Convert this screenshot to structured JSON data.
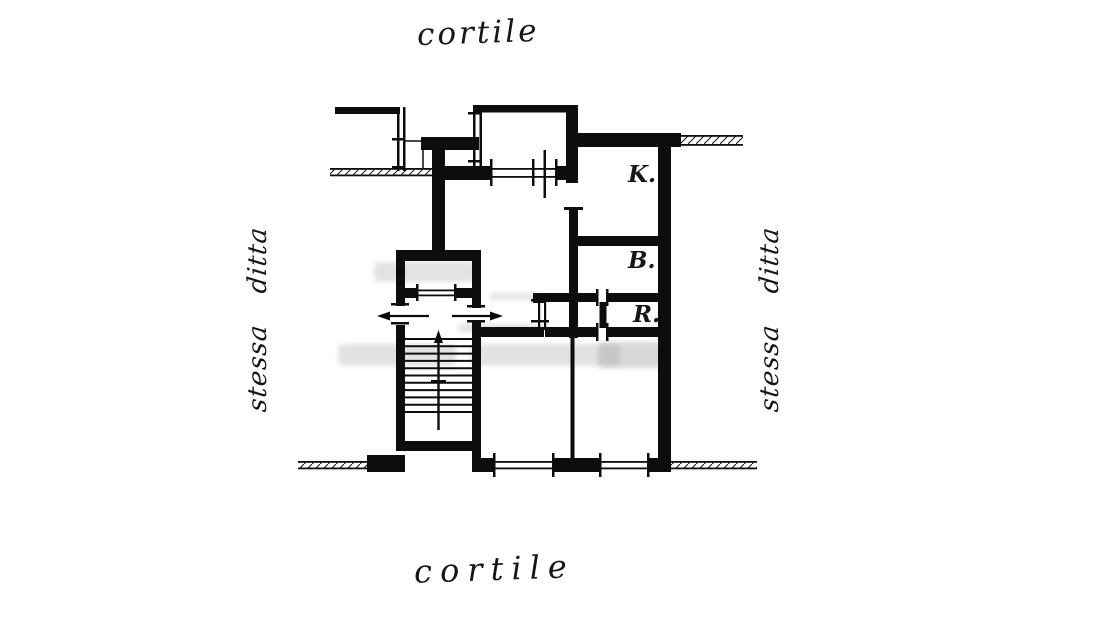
{
  "labels": {
    "courtyard_top": "cortile",
    "courtyard_bottom": "cortile",
    "side_left": "stessa ditta",
    "side_right": "stessa ditta",
    "room_k": "K.",
    "room_b": "B.",
    "room_r": "R."
  },
  "colors": {
    "ink": "#111111",
    "paper": "#ffffff",
    "watermark": "#9b9b9b"
  },
  "plan": {
    "type": "floor-plan",
    "rooms": [
      "K.",
      "B.",
      "R."
    ],
    "features": [
      "staircase",
      "elevator-shaft",
      "balcony",
      "courtyard-top",
      "courtyard-bottom"
    ]
  }
}
